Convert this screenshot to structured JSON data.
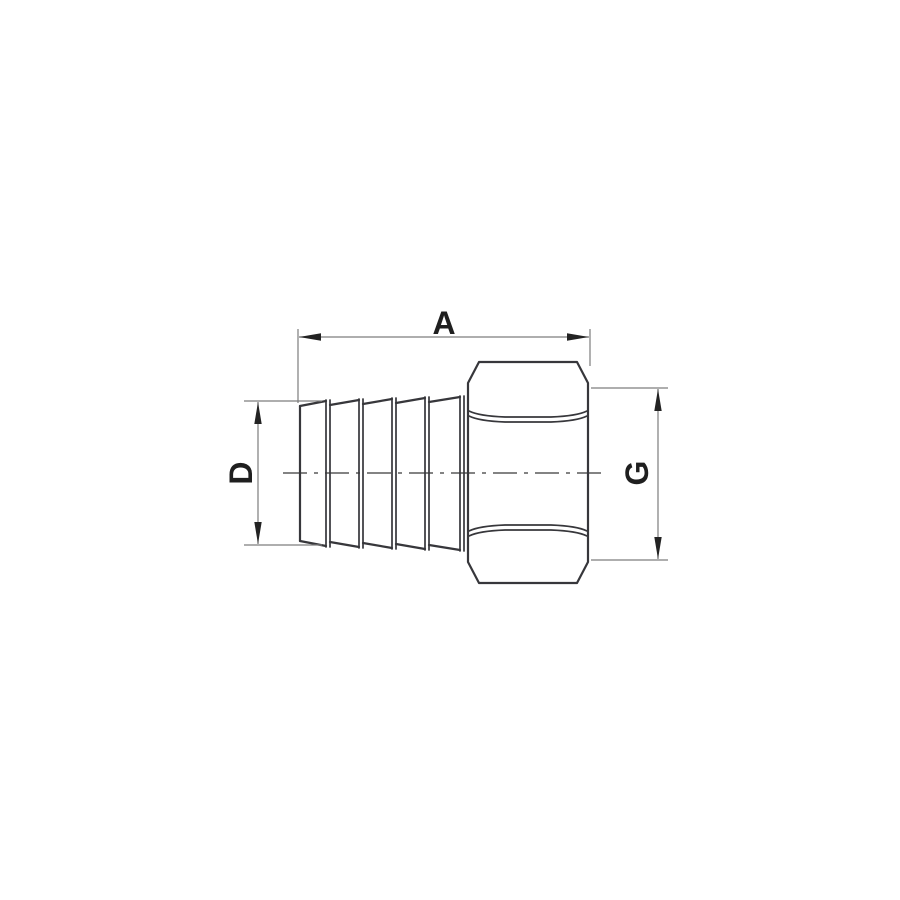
{
  "drawing": {
    "kind": "technical-dimension-drawing",
    "subject": "hose-barb-fitting-with-hex-nut",
    "dimensions": [
      {
        "id": "a",
        "label": "A",
        "orientation": "horizontal",
        "position": "top"
      },
      {
        "id": "d",
        "label": "D",
        "orientation": "vertical",
        "position": "left"
      },
      {
        "id": "g",
        "label": "G",
        "orientation": "vertical",
        "position": "right"
      }
    ]
  },
  "colors": {
    "background": "#ffffff",
    "outline": "#37373b",
    "dimension_line": "#7d7d7d",
    "centerline": "#5a5a5a",
    "arrow": "#232323",
    "label": "#1f1f1f"
  }
}
